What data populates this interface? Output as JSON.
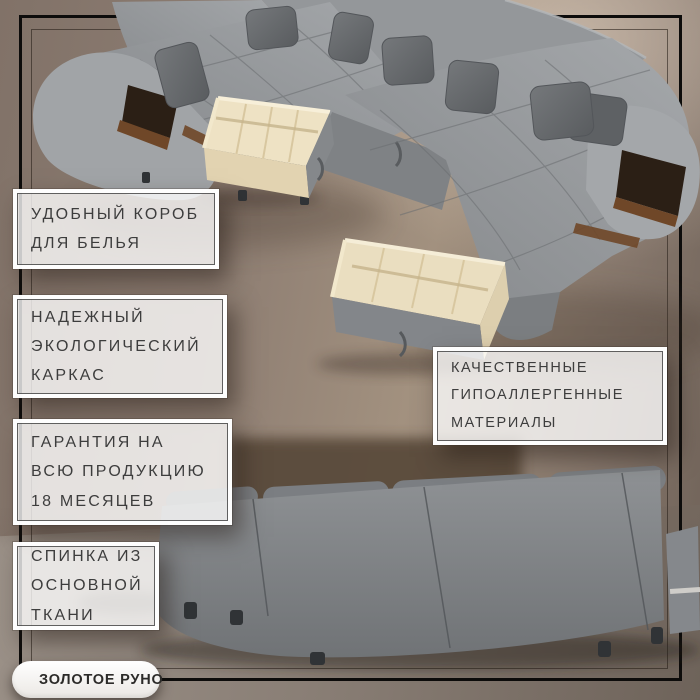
{
  "callouts": [
    {
      "id": "laundry-storage",
      "lines": [
        "УДОБНЫЙ КОРОБ",
        "ДЛЯ БЕЛЬЯ"
      ]
    },
    {
      "id": "eco-frame",
      "lines": [
        "НАДЕЖНЫЙ",
        "ЭКОЛОГИЧЕСКИЙ",
        "КАРКАС"
      ]
    },
    {
      "id": "warranty",
      "lines": [
        "ГАРАНТИЯ НА",
        "ВСЮ ПРОДУКЦИЮ",
        "18 МЕСЯЦЕВ"
      ]
    },
    {
      "id": "backrest-fabric",
      "lines": [
        "СПИНКА ИЗ",
        "ОСНОВНОЙ",
        "ТКАНИ"
      ]
    },
    {
      "id": "materials",
      "lines": [
        "КАЧЕСТВЕННЫЕ",
        "ГИПОАЛЛЕРГЕННЫЕ",
        "МАТЕРИАЛЫ"
      ]
    }
  ],
  "logo": {
    "label": "ЗОЛОТОЕ РУНО",
    "emblem_icon": "golden-rings-emblem-icon"
  },
  "colors": {
    "background_left": "#817268",
    "background_highlight": "#ebdbcb",
    "background_right": "#6e6157",
    "floor": "#8a7f76",
    "frame_line": "#0d0c0b",
    "callout_text": "#3d3d3d",
    "callout_border_inner": "#484848",
    "sofa_grey": "#8f9294",
    "pillow_grey": "#64676a",
    "drawer_wood": "#ece0c2",
    "wood_trim": "#6f4728",
    "dark_niche": "#2b1f15",
    "logo_gold": "#ab8a2e",
    "logo_text": "#2c2b29"
  }
}
